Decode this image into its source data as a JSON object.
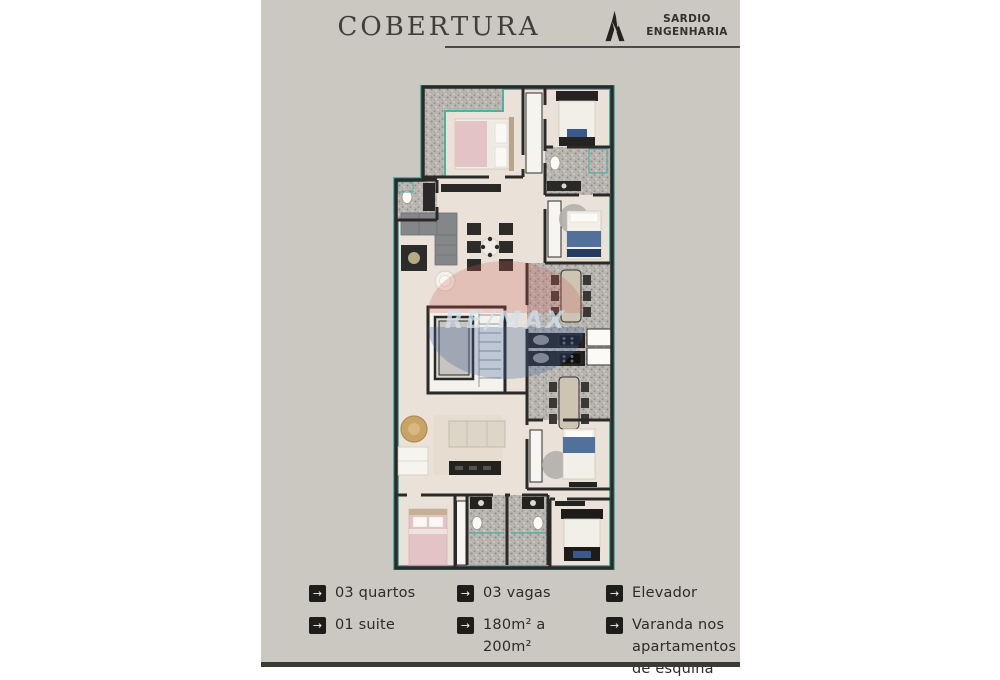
{
  "header": {
    "title": "COBERTURA",
    "brand_line1": "SARDIO",
    "brand_line2": "ENGENHARIA"
  },
  "watermark": {
    "text": "RE/MAX"
  },
  "features": {
    "arrow_icon": "→",
    "items": [
      {
        "label": "03 quartos"
      },
      {
        "label": "03 vagas"
      },
      {
        "label": "Elevador"
      },
      {
        "label": "01 suite"
      },
      {
        "label": "180m² a 200m²"
      },
      {
        "label": "Varanda nos apartamentos de esquina"
      }
    ]
  },
  "colors": {
    "page_background": "#ffffff",
    "flyer_background": "#cbc7c1",
    "title_text": "#403e3a",
    "feature_text": "#2d2b28",
    "badge_background": "#1e1d1b",
    "badge_arrow": "#f5f3ef",
    "wall": "#2b2a28",
    "floor": "#eae2d8",
    "granite": "#bab6b2",
    "teal_accent": "#55ada3",
    "watermark_red": "#cf5a52",
    "watermark_blue": "#41649c"
  }
}
